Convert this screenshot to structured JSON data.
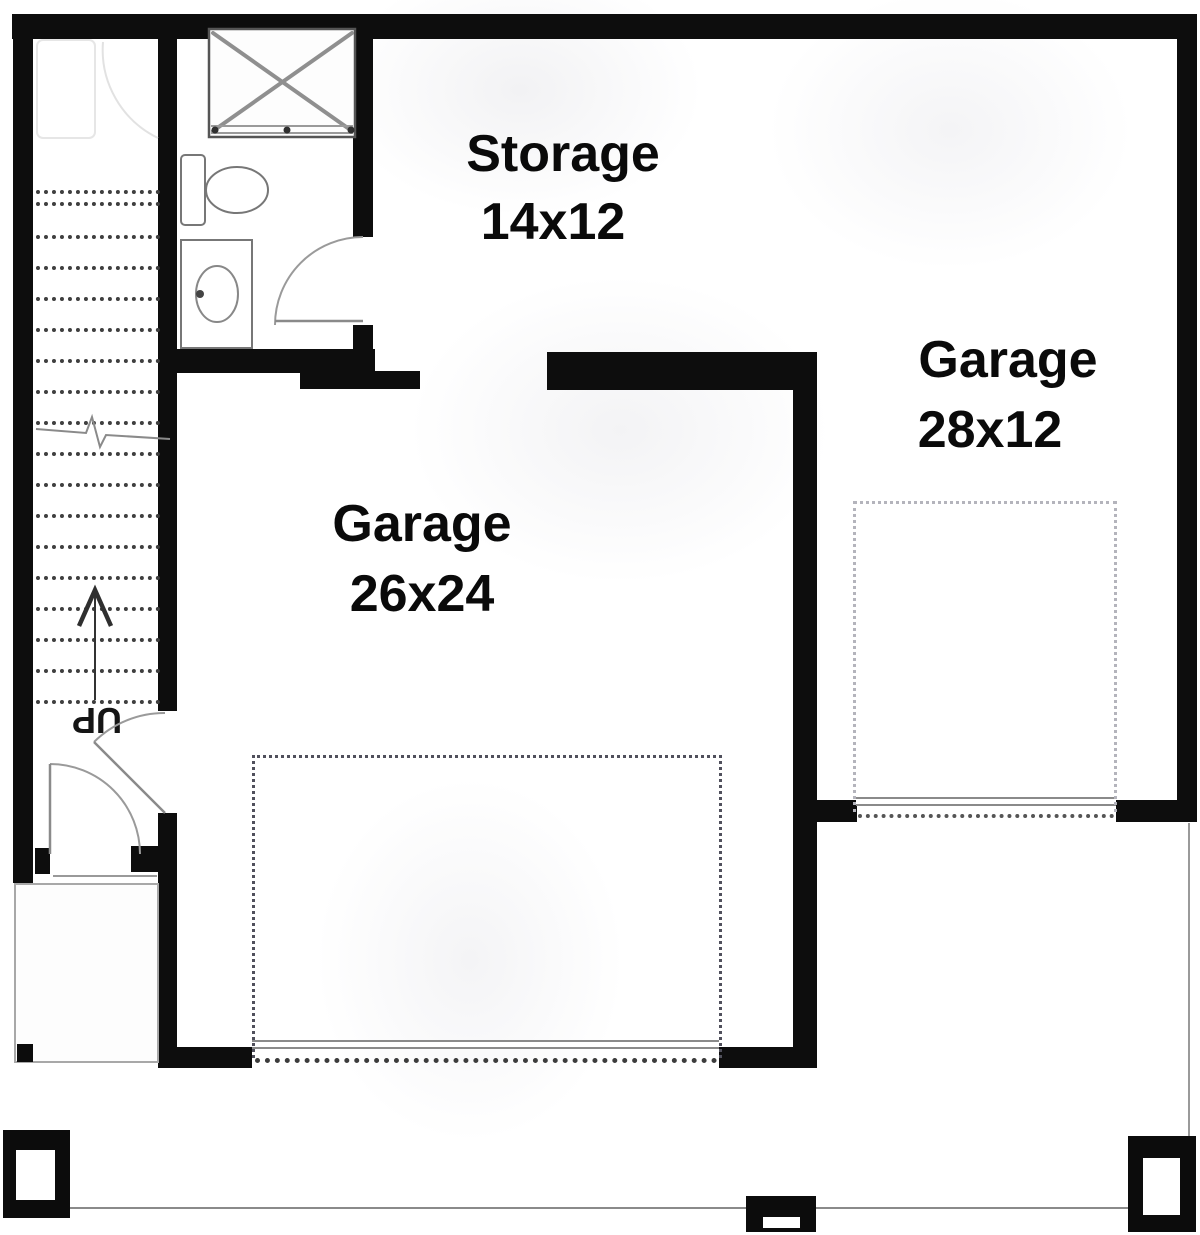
{
  "title": "Garage floor plan",
  "rooms": {
    "storage": {
      "label": "Storage",
      "dims": "14x12"
    },
    "garage_main": {
      "label": "Garage",
      "dims": "26x24"
    },
    "garage_right": {
      "label": "Garage",
      "dims": "28x12"
    }
  },
  "stairs": {
    "label": "UP",
    "direction_icon": "up-arrow-icon",
    "tread_style": "dotted"
  },
  "fixtures": [
    "shower",
    "toilet",
    "sink-vanity"
  ],
  "doors": [
    "bathroom-door",
    "garage-hall-door",
    "exterior-entry-door"
  ],
  "colors": {
    "wall": "#0d0d0d",
    "fixture_stroke": "#777777",
    "door_stroke": "#8a8a8a",
    "tread_dot": "#3f3f3f",
    "parking_dash_dark": "#50505c",
    "parking_dash_light": "#b4b4bc",
    "porch_line": "#8a8a8a"
  }
}
